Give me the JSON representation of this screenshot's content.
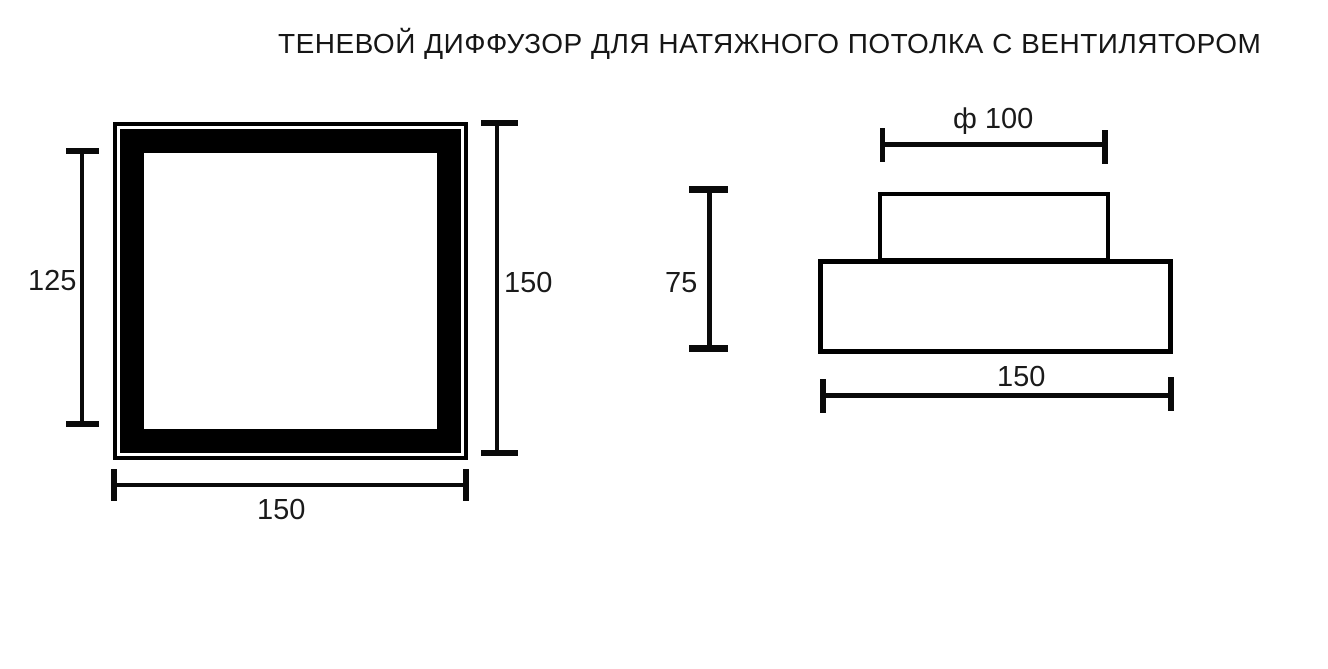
{
  "title": "ТЕНЕВОЙ ДИФФУЗОР ДЛЯ НАТЯЖНОГО ПОТОЛКА С ВЕНТИЛЯТОРОМ",
  "front_view": {
    "dim_inner_height": "125",
    "dim_height": "150",
    "dim_width": "150"
  },
  "side_view": {
    "dim_diameter": "ф 100",
    "dim_height": "75",
    "dim_width": "150"
  },
  "colors": {
    "line": "#000000",
    "text": "#1a1a1a",
    "background": "#ffffff"
  }
}
